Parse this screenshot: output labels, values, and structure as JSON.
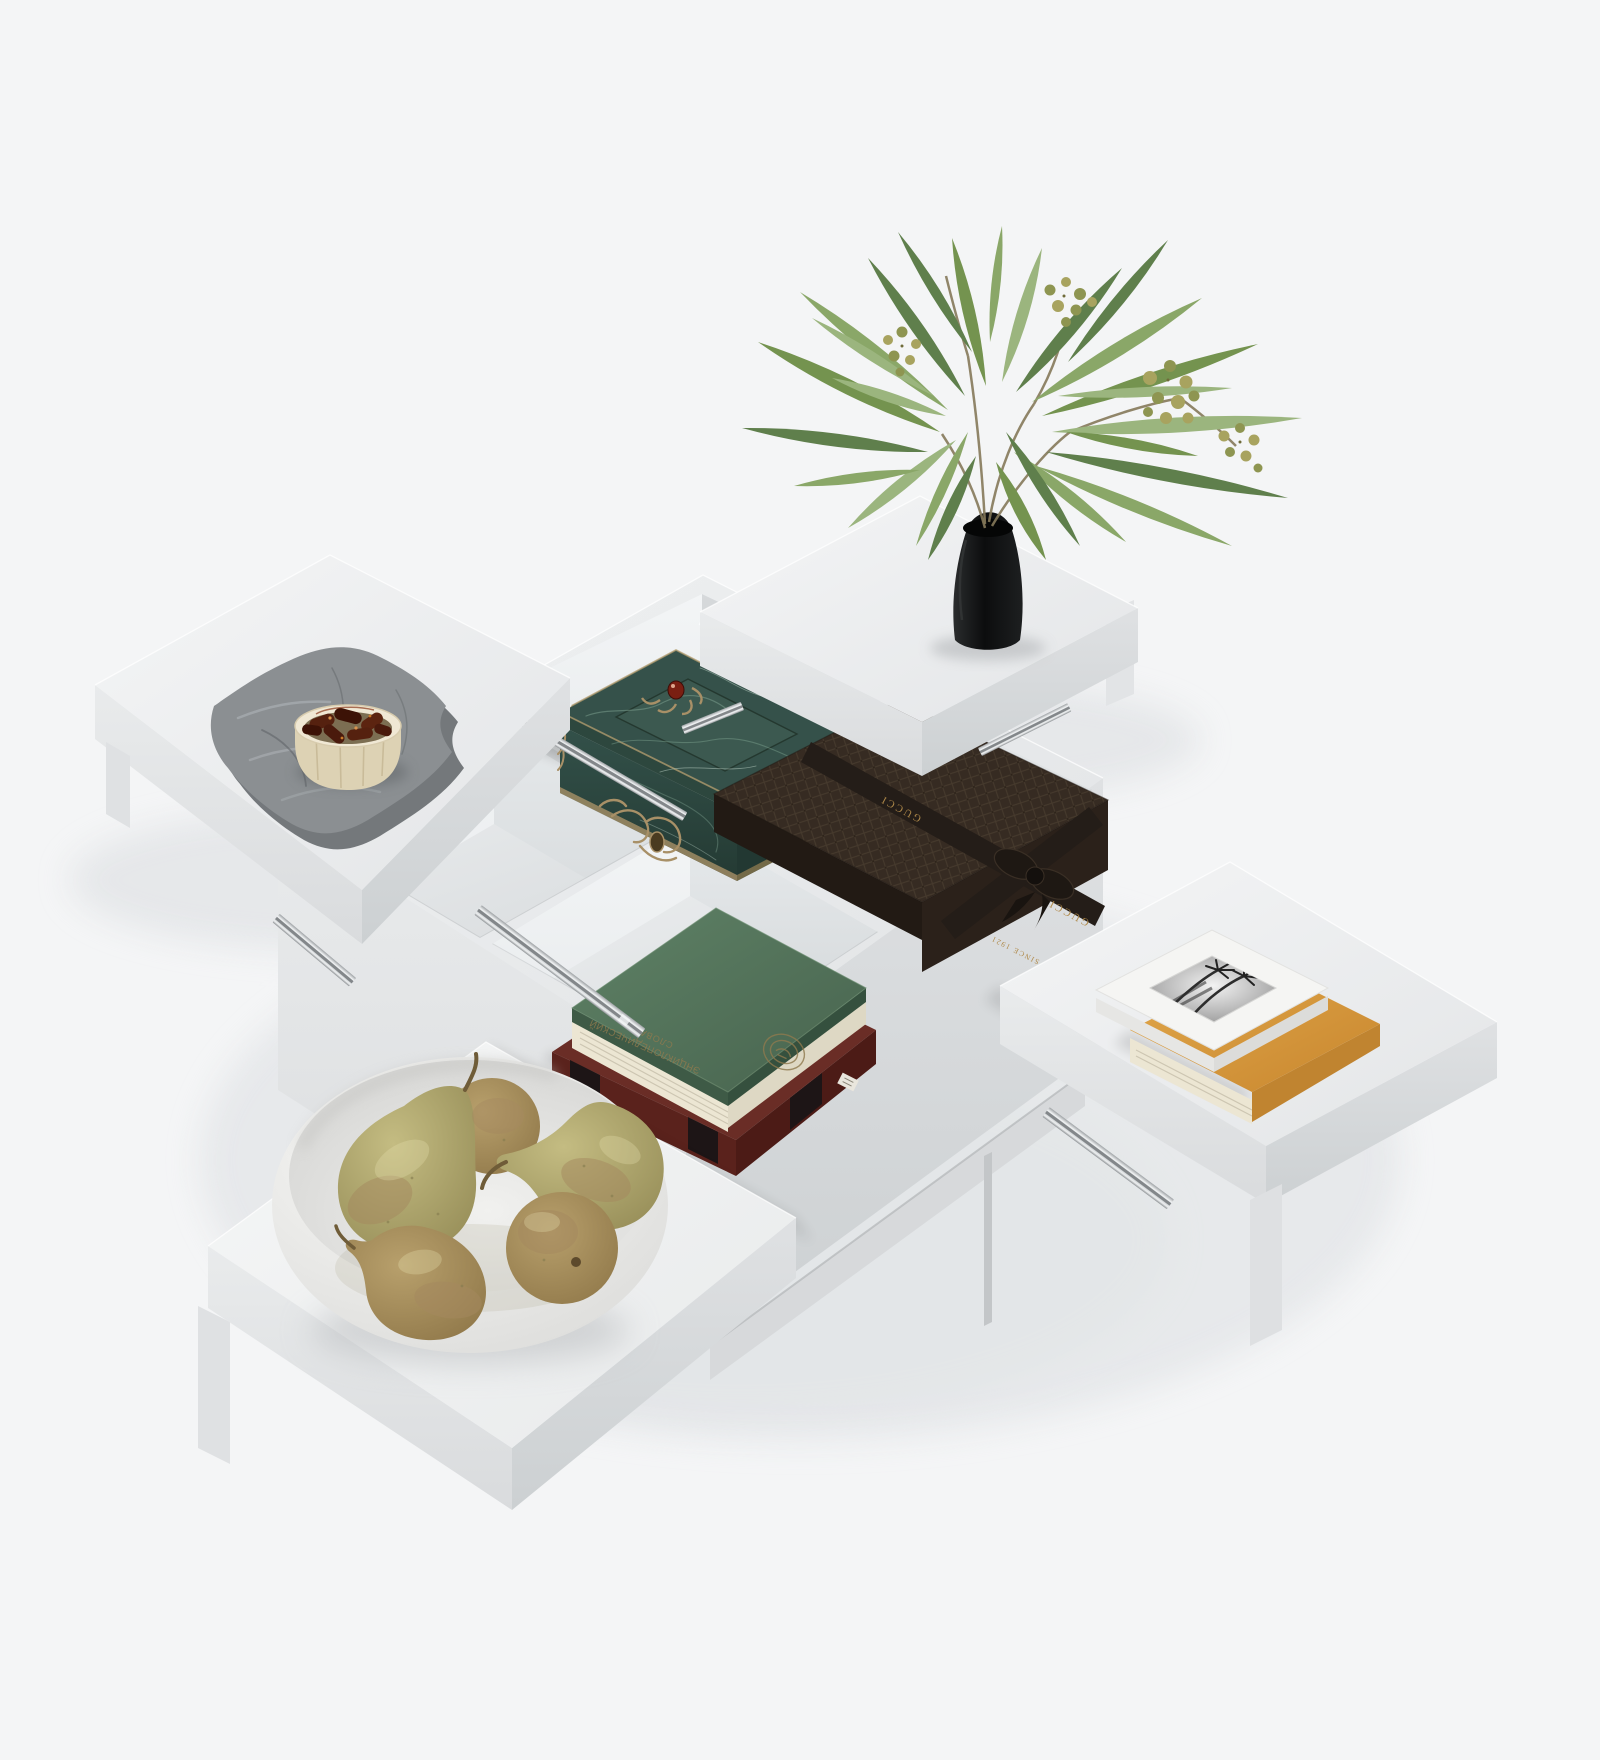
{
  "scene": {
    "description": "Top-angle render of a white four-module coffee table with sliding square tops, each top slid open diagonally to reveal a storage compartment",
    "furniture": {
      "name": "modular sliding-top coffee table",
      "modules": 4,
      "hardware": "telescopic ball-bearing drawer slides"
    },
    "compartments": [
      {
        "position": "top-center",
        "contents": "green marble jewelry box with brass trim and red gem finial"
      },
      {
        "position": "center-left",
        "contents": "empty compartment with round black bowl"
      },
      {
        "position": "bottom-center",
        "contents": "green hardcover dictionary stacked on dark red book"
      },
      {
        "position": "center-right",
        "contents": "dark brown Gucci gift box with dark ribbon and bow"
      }
    ],
    "sliding_tops": [
      {
        "position": "upper-left",
        "items": [
          "folded gray linen napkin",
          "wooden bowl of dried dates"
        ]
      },
      {
        "position": "upper-right",
        "items": [
          "black vase with olive branches and berries"
        ]
      },
      {
        "position": "lower-right",
        "items": [
          "white palm-photo book",
          "orange hardcover book"
        ]
      },
      {
        "position": "lower-left",
        "items": [
          "white bowl with five pears"
        ]
      }
    ],
    "labels": {
      "gucci_ribbon": "GUCCI",
      "gucci_since": "SINCE 1921",
      "green_book_title_line1": "ЭНЦИКЛОПЕДИЧЕСКИЙ",
      "green_book_title_line2": "СЛОВАРЬ"
    },
    "colors": {
      "bg": "#f4f5f6",
      "white": "#eef0f1",
      "whiteSide": "#dfe1e3",
      "wall": "#f1f3f4",
      "wallShade": "#e3e6e8",
      "floorCol": "#e8eaeb",
      "metal": "#c6c9cc",
      "metalDark": "#83878a",
      "vase": "#131415",
      "leaf1": "#74934f",
      "leaf2": "#5f7f4c",
      "leaf3": "#8aa768",
      "leaf4": "#9bb57e",
      "stem": "#85795a",
      "berry": "#a8a35f",
      "berryDark": "#8e9551",
      "marble": "#35514a",
      "marbleVein": "#7fa391",
      "brass": "#a89067",
      "gem": "#7a1f12",
      "cloth": "#8b8f92",
      "wood": "#ddd2b4",
      "date": "#55210f",
      "bowlWhite": "#f2f2f0",
      "pear": "#b4ab74",
      "russet": "#a5895f",
      "gucci": "#342a22",
      "ribbon": "#241d18",
      "gold": "#b08a4a",
      "bookGreen": "#567659",
      "bookGold": "#8f7a4e",
      "bookRed": "#6a2d26",
      "bookOrange": "#d99b3f",
      "pages": "#ece6d3",
      "photo": "#9a9a9a"
    }
  }
}
